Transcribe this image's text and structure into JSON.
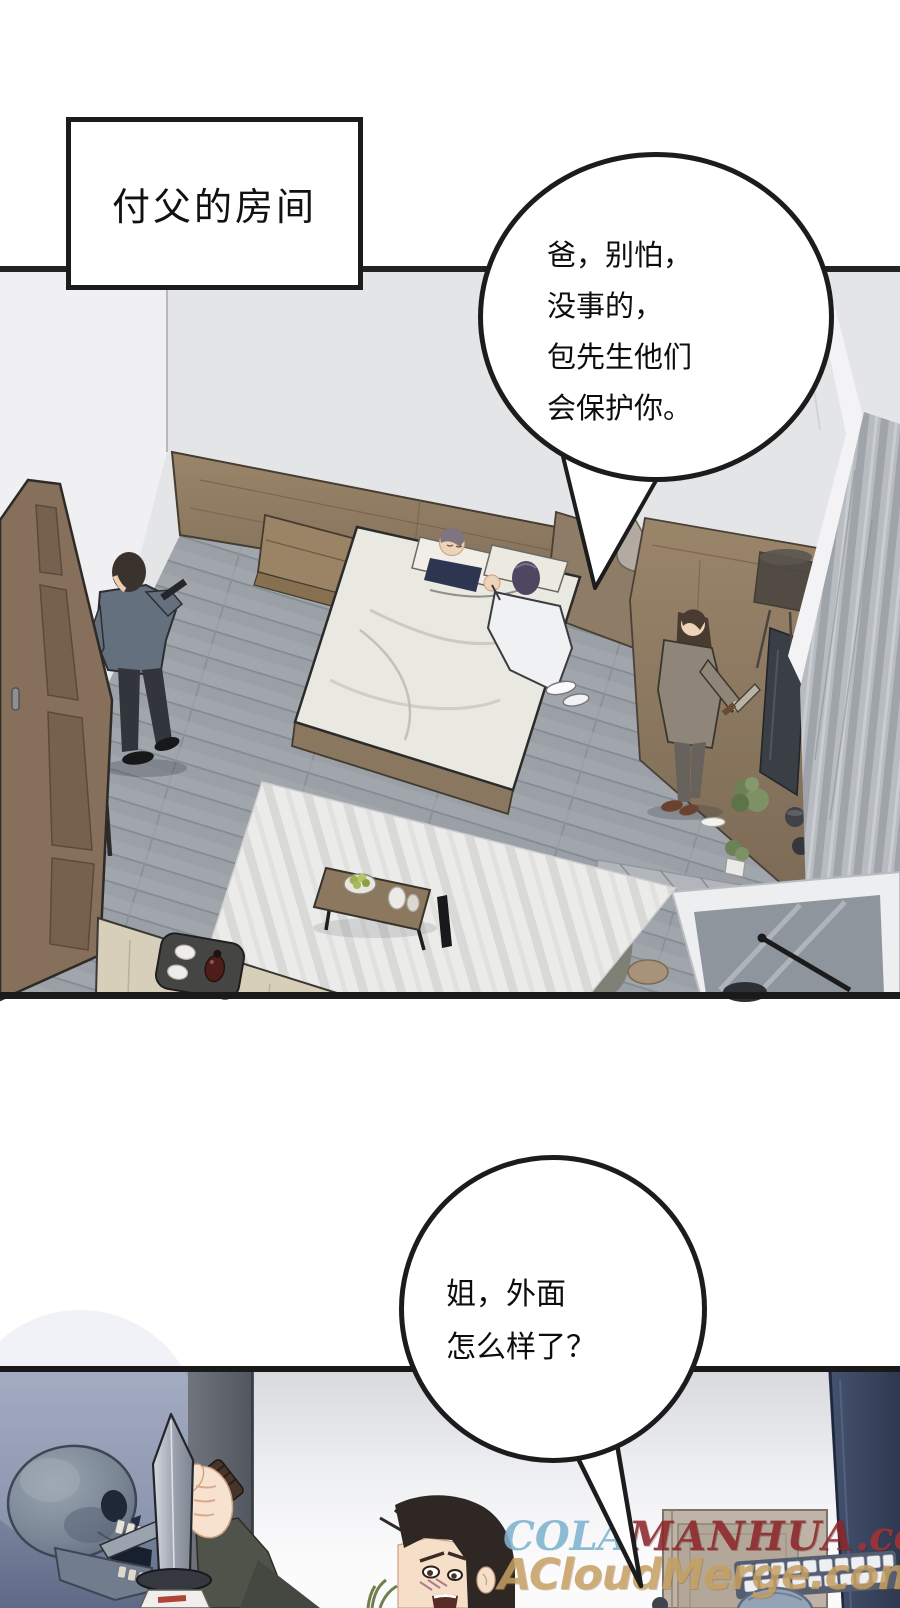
{
  "page": {
    "width": 900,
    "height": 1608,
    "background": "#ffffff"
  },
  "caption_box": {
    "text": "付父的房间"
  },
  "bubbles": {
    "bubble1": {
      "lines": [
        "爸，别怕，",
        "没事的，",
        "包先生他们",
        "会保护你。"
      ]
    },
    "bubble2": {
      "lines": [
        "姐，外面",
        "怎么样了？"
      ]
    }
  },
  "watermark": {
    "cola": "COLA",
    "manhua": "MANHUA",
    "domain_suffix": ".com",
    "line2": "ACloudMerge.com",
    "colors": {
      "cola": "#7fb3cf",
      "manhua": "#8e262b",
      "domain_suffix": "#a53237",
      "line2": "#c59f62"
    }
  },
  "scene_colors": {
    "wall": "#e4e5e7",
    "left_wall": "#f0f0f2",
    "floor": "#9aa0a6",
    "wood": "#8b7763",
    "duvet": "#e9e8e1",
    "panel_border": "#1c1c1c",
    "night_scene_top": "#99a1b8",
    "night_scene_bottom": "#5e6a86",
    "navy_pillar": "#36425e",
    "blade": "#c6cbd3",
    "skin": "#f2d7c3",
    "tv": "#3a3f46",
    "rug": "#ebebe9",
    "ottoman": "#d8cfba"
  }
}
